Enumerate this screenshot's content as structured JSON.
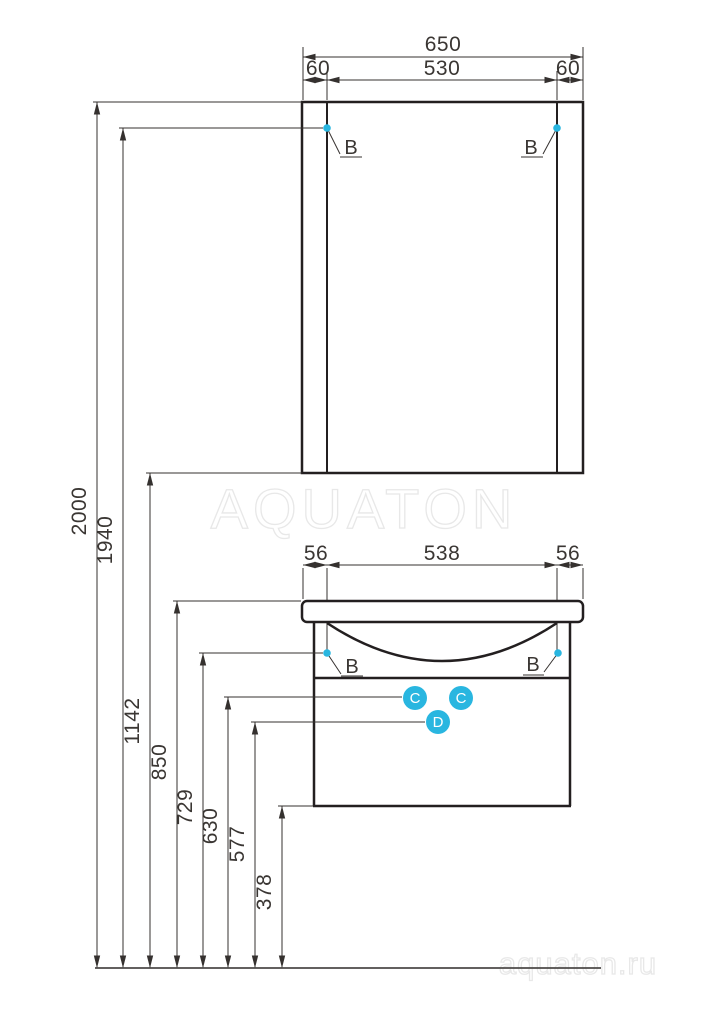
{
  "watermarks": {
    "center": "AQUATON",
    "corner": "aquaton.ru"
  },
  "colors": {
    "accent": "#29b6e0",
    "line": "#231f20",
    "watermark": "#e8e8e8"
  },
  "mirror_dims": {
    "total": "650",
    "left": "60",
    "center": "530",
    "right": "60"
  },
  "vanity_dims": {
    "left": "56",
    "center": "538",
    "right": "56"
  },
  "heights": [
    "2000",
    "1940",
    "1142",
    "850",
    "729",
    "630",
    "577",
    "378"
  ],
  "callouts": {
    "mirror_left": "B",
    "mirror_right": "B",
    "vanity_left": "B",
    "vanity_right": "B",
    "circle_c1": "C",
    "circle_c2": "C",
    "circle_d": "D"
  }
}
